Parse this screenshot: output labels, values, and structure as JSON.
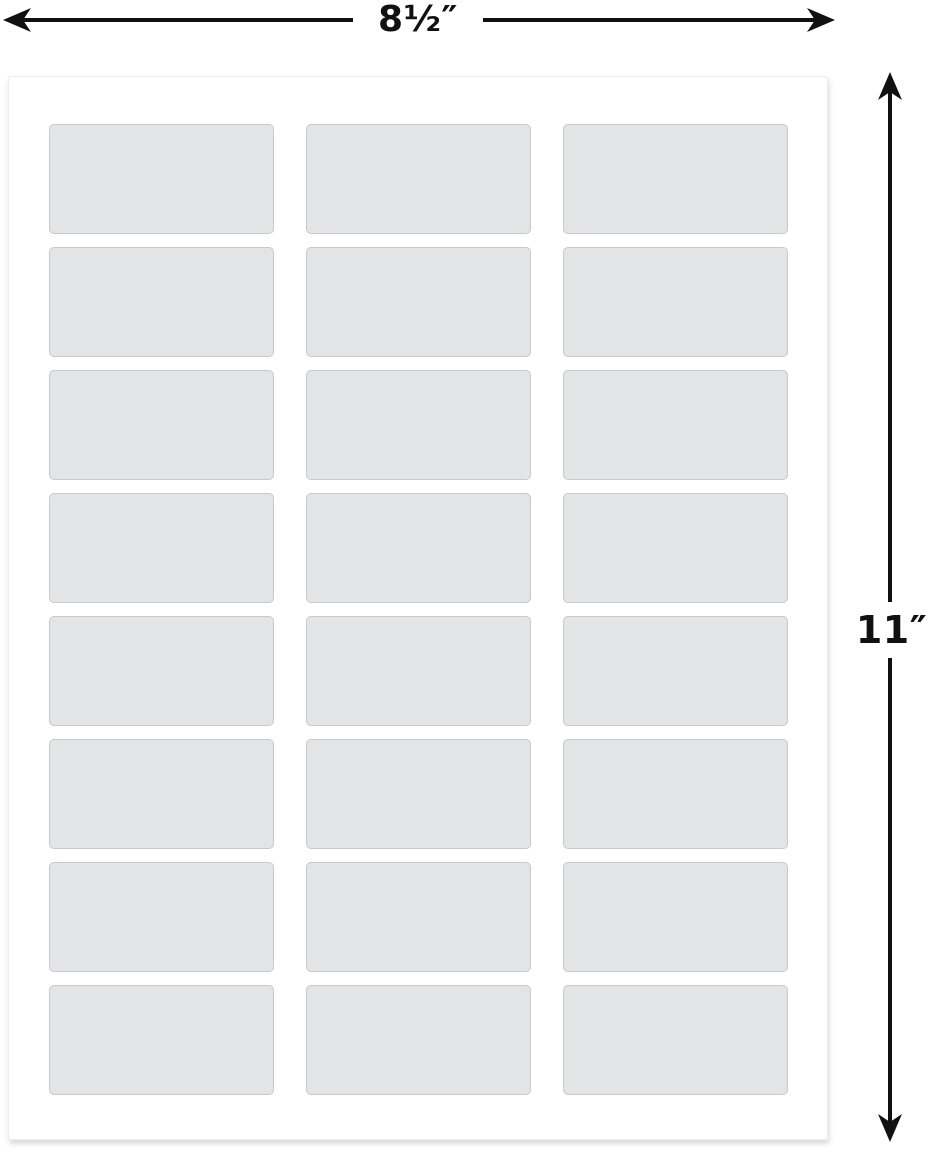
{
  "diagram": {
    "width_label": "8½″",
    "height_label": "11″",
    "sheet": {
      "rows": 8,
      "columns": 3,
      "label_count": 24
    },
    "colors": {
      "arrow-color": "#111111",
      "sheet-bg": "#ffffff",
      "sheet-border": "#ececec",
      "label-fill": "#e2e4e5",
      "label-border": "#c6cacc",
      "page-bg": "#ffffff"
    }
  }
}
